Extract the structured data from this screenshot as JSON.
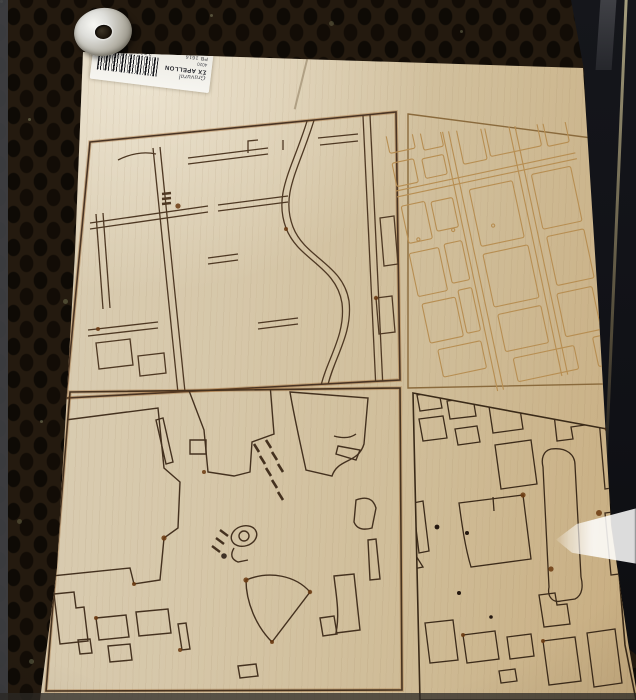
{
  "scene": {
    "subject": "laser-cut plywood sheet with four engraved city-map panels",
    "setting": "honeycomb laser-cutter bed"
  },
  "sticker": {
    "script_text": "Gravural",
    "logo_mark": "ΣX",
    "brand": "APELLON",
    "small_code": "4020",
    "product_code": "PB 1616",
    "barcode_number": "37080 81420"
  },
  "panels": [
    {
      "id": "top-left",
      "content": "street-network-map",
      "line_color": "#4a3423"
    },
    {
      "id": "top-right",
      "content": "city-blocks-light-engraving",
      "line_color": "#b78e52"
    },
    {
      "id": "bottom-left",
      "content": "building-footprints-sparse",
      "line_color": "#44311f"
    },
    {
      "id": "bottom-right",
      "content": "building-footprints-dense",
      "line_color": "#3a2a18"
    }
  ],
  "colors": {
    "bed_dark": "#0e0a05",
    "bed_web": "#241a0f",
    "wood_light": "#dbcfb6",
    "wood_warm": "#c8ad80",
    "burn_mark": "#6b3a10",
    "label_white": "#f4f3ee",
    "metal_silver": "#d9d8d2",
    "machine_dark": "#101116",
    "glare_white": "#ffffff"
  }
}
